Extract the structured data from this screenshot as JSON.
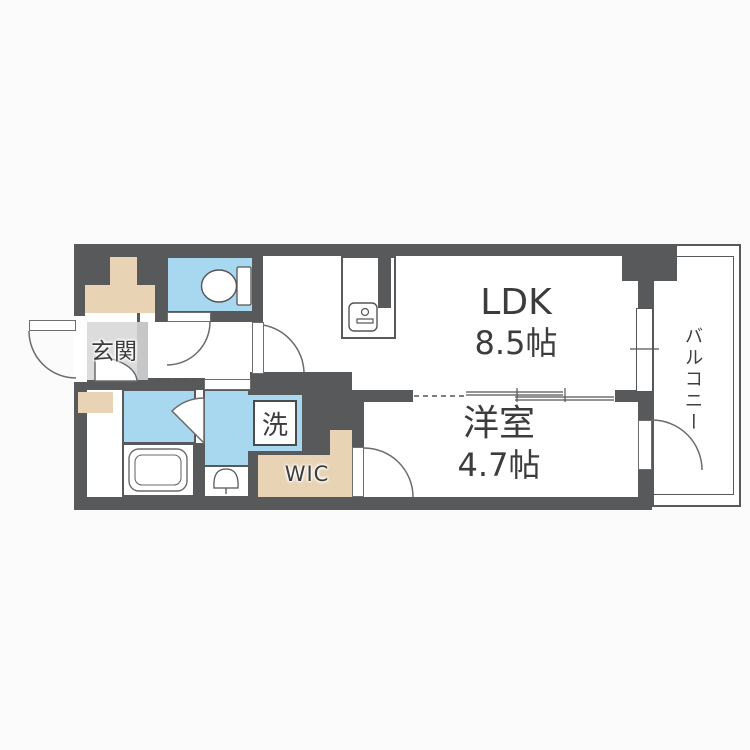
{
  "rooms": {
    "genkan": {
      "label": "玄関"
    },
    "ldk": {
      "label": "LDK",
      "size": "8.5帖"
    },
    "western": {
      "label": "洋室",
      "size": "4.7帖"
    },
    "wic": {
      "label": "WIC"
    },
    "laundry": {
      "label": "洗"
    },
    "balcony": {
      "label": "バルコニー"
    }
  },
  "colors": {
    "wall": "#58595b",
    "water": "#a8d7f0",
    "storage": "#e8d4b5",
    "genkan_floor": "#dcdcdd",
    "genkan_step": "#c6c7c8",
    "line": "#6b6b6b",
    "text": "#3c3c3c"
  }
}
